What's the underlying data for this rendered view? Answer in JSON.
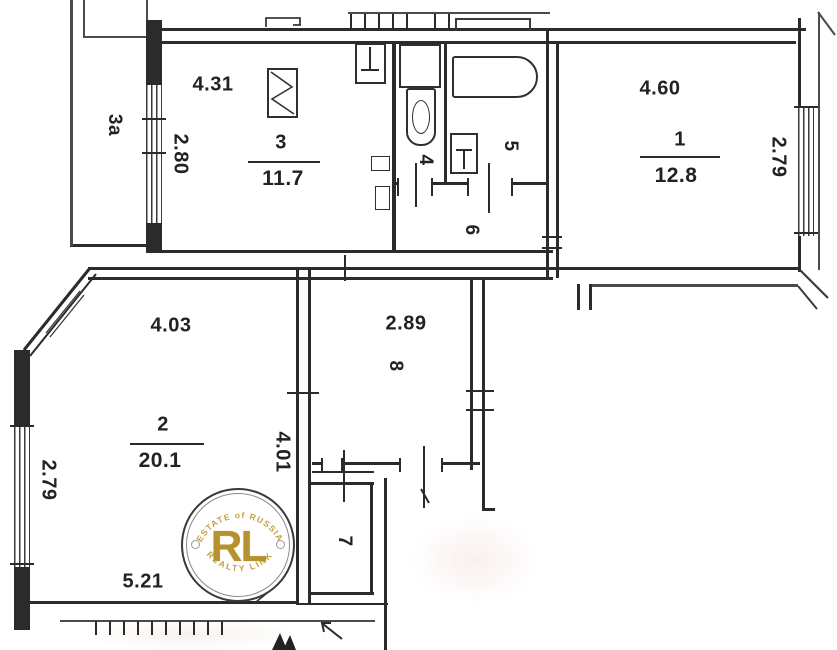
{
  "document": {
    "type": "apartment floor plan (scanned)"
  },
  "rooms": {
    "r1": {
      "number": "1",
      "area": "12.8",
      "dim_top": "4.60",
      "dim_right": "2.79"
    },
    "r2": {
      "number": "2",
      "area": "20.1",
      "dim_top": "4.03",
      "dim_left": "2.79",
      "dim_right": "4.01",
      "dim_bottom": "5.21"
    },
    "r3": {
      "number": "3",
      "area": "11.7",
      "dim_top": "4.31",
      "dim_left": "2.80"
    },
    "r3a": {
      "number": "3a"
    },
    "r4": {
      "number": "4"
    },
    "r5": {
      "number": "5"
    },
    "r6": {
      "number": "6"
    },
    "r7": {
      "number": "7"
    },
    "r8": {
      "number": "8",
      "dim_top": "2.89"
    }
  },
  "fixtures": {
    "stove": "zigzag-rectangle",
    "kitchen_sink": "inverted-tee-basin",
    "washing_machine": "rectangle",
    "toilet": "bowl-with-oval",
    "bathtub": "rounded-rectangle",
    "bath_sink": "tee-basin"
  },
  "watermark": {
    "monogram": "RL",
    "arc_top": "ESTATE of RUSSIA",
    "arc_bottom": "REALTY LINK",
    "gold_color": "#b6922e",
    "ring_color": "#3a3a3a"
  },
  "colors": {
    "line": "#2b2b2b",
    "background": "#ffffff"
  }
}
